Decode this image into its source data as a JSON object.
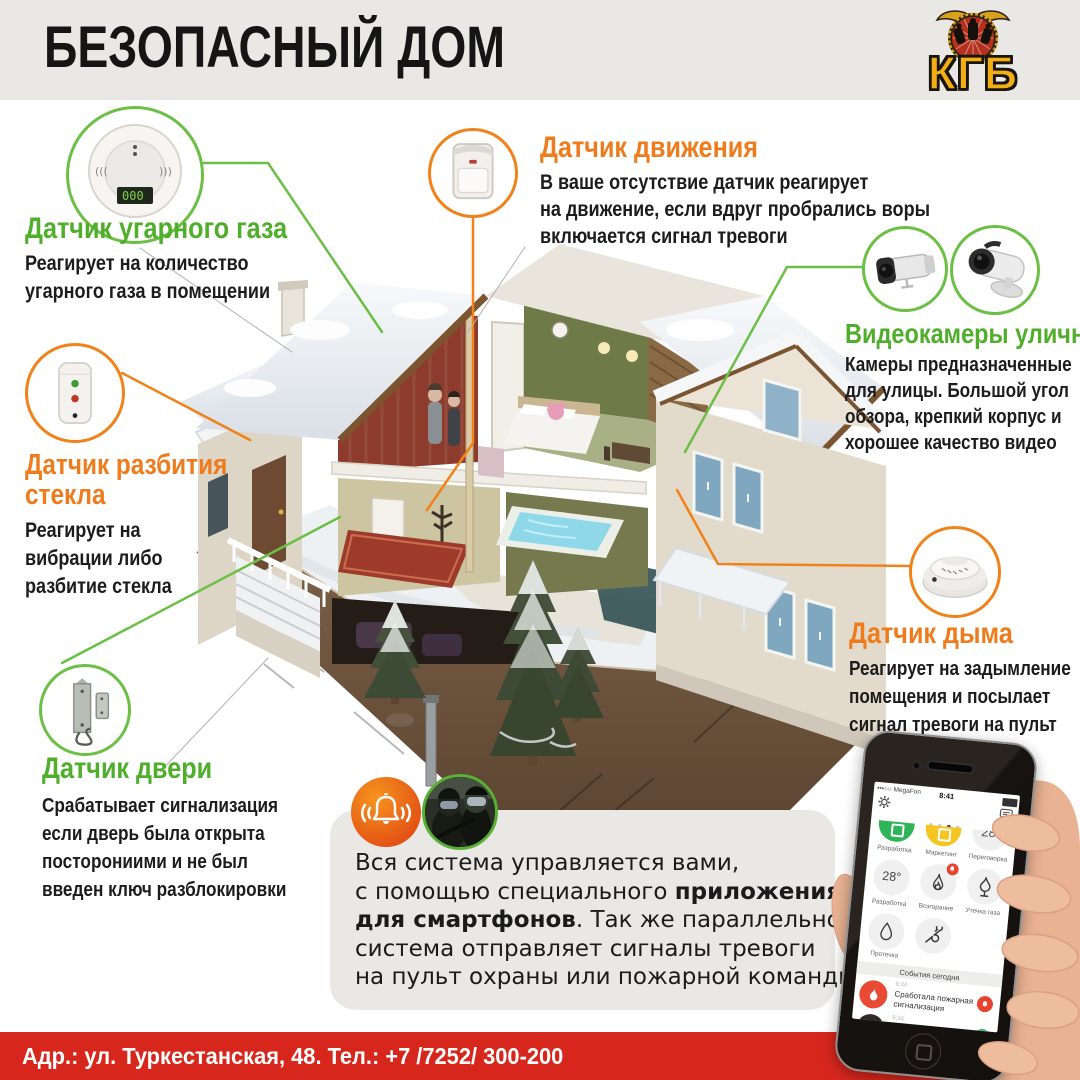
{
  "header": {
    "title": "БЕЗОПАСНЫЙ ДОМ",
    "logo_text": "КГБ"
  },
  "sensors": {
    "co": {
      "title": "Датчик угарного газа",
      "desc_lines": [
        "Реагирует на количество",
        "угарного газа в помещении"
      ]
    },
    "motion": {
      "title": "Датчик движения",
      "desc_lines": [
        "В ваше отсутствие датчик реагирует",
        "на движение, если вдруг пробрались воры",
        "включается сигнал тревоги"
      ]
    },
    "cameras": {
      "title": "Видеокамеры уличные",
      "desc_lines": [
        "Камеры предназначенные",
        "для улицы. Большой угол",
        "обзора, крепкий корпус и",
        "хорошее качество видео"
      ]
    },
    "glass": {
      "title_lines": [
        "Датчик разбития",
        "стекла"
      ],
      "desc_lines": [
        "Реагирует на",
        "вибрации либо",
        "разбитие стекла"
      ]
    },
    "smoke": {
      "title": "Датчик дыма",
      "desc_lines": [
        "Реагирует на задымление",
        "помещения и посылает",
        "сигнал тревоги на пульт"
      ]
    },
    "door": {
      "title": "Датчик двери",
      "desc_lines": [
        "Срабатывает сигнализация",
        "если дверь была открыта",
        "посторониими и не был",
        "введен ключ разблокировки"
      ]
    }
  },
  "app_note": {
    "line1": "Вся система управляется вами,",
    "line2_normal": "с помощью специального ",
    "line2_bold": "приложения",
    "line3_bold": "для смартфонов",
    "line3_normal": ". Так же параллельно,",
    "line4": "система отправляет сигналы тревоги",
    "line5": "на пульт охраны или пожарной команды."
  },
  "phone_app": {
    "carrier": "•••○○ MegaFon",
    "time": "8:41",
    "tiles": {
      "row1_labels": [
        "Разработка",
        "Маркетинг",
        "Переговорка"
      ],
      "row1_value": "28",
      "row2_labels": [
        "Разработка",
        "Возгорание",
        "Утечка газа"
      ],
      "row2_value": "28°",
      "row3_label": "Протечка"
    },
    "events_header": "События сегодня",
    "events": [
      {
        "time": "9:34",
        "line1": "Сработала пожарная",
        "line2": "сигнализация"
      },
      {
        "time": "9:34",
        "line1": "Никита Демидов,"
      }
    ],
    "icons": {
      "settings": "gear-icon",
      "messages": "chat-icon",
      "fire": "flame-icon",
      "gas": "gas-flame-icon",
      "leak": "drop-icon",
      "service": "wrench-icon",
      "alarm": "bell-icon",
      "answer": "handset-icon"
    }
  },
  "badges": {
    "alarm": "alarm-bell-icon",
    "response_team": "swat-team-photo"
  },
  "footer": {
    "address": "Адр.: ул. Туркестанская, 48. Тел.: +7 /7252/ 300-200"
  },
  "colors": {
    "green": "#4fae2a",
    "orange": "#ee7c1c",
    "red": "#d7271d",
    "header_bg": "#e9e8e5",
    "panel_bg": "#e9e8e4",
    "logo_yellow": "#f2ae14"
  }
}
